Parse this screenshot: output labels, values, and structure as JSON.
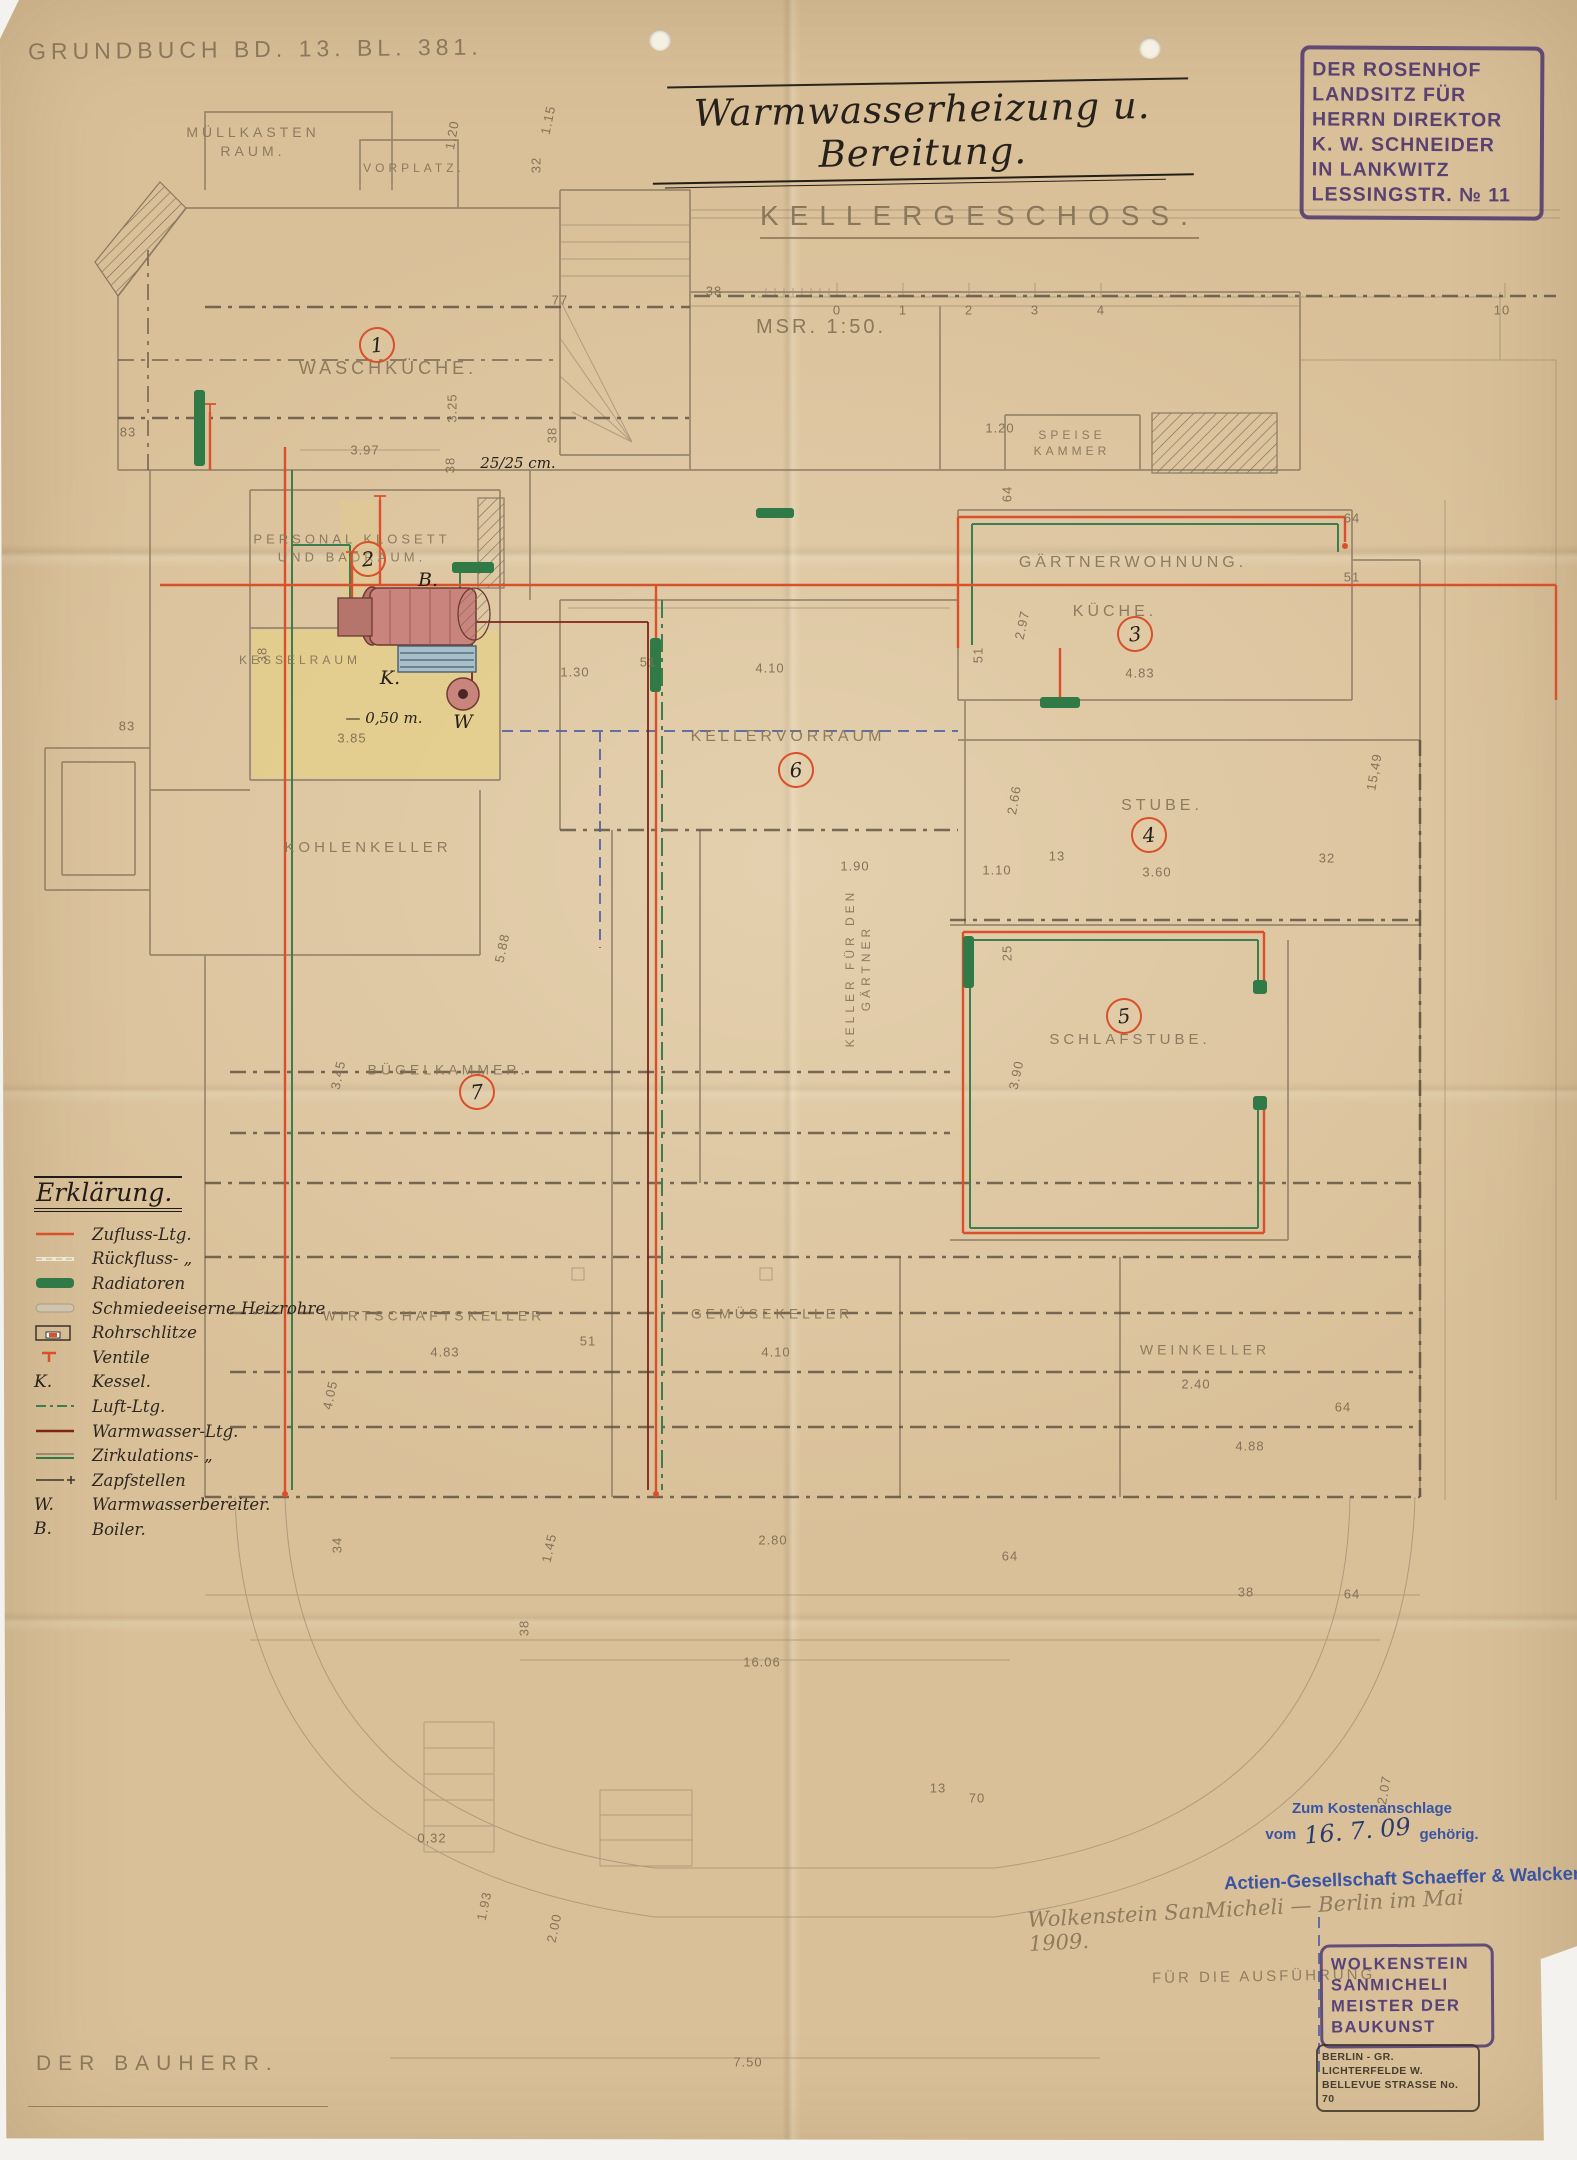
{
  "colors": {
    "paper": "#d9c099",
    "pencil": "#8a7962",
    "ink": "#27211b",
    "supply_red": "#d9502a",
    "warmwasser_dark_red": "#7e2418",
    "radiator_green": "#2f7a46",
    "luft_green": "#3e7d4e",
    "blue_line": "#4e5fa3",
    "stamp_purple": "#533a70",
    "stamp_blue": "#3a54a4",
    "highlight_yellow": "#e8d47b"
  },
  "header": {
    "grundbuch": "Grundbuch Bd. 13. Bl. 381.",
    "title": "Warmwasserheizung u. Bereitung.",
    "floor": "Kellergeschoss.",
    "scale": "Msr. 1:50."
  },
  "owner_stamp": {
    "lines": [
      "DER ROSENHOF",
      "LANDSITZ FÜR",
      "HERRN DIREKTOR",
      "K. W. SCHNEIDER",
      "IN LANKWITZ",
      "LESSINGSTR. № 11"
    ]
  },
  "legend": {
    "title": "Erklärung.",
    "items": [
      {
        "symbol": "supply-line",
        "label": "Zufluss-Ltg."
      },
      {
        "symbol": "return-line",
        "label": "Rückfluss- „"
      },
      {
        "symbol": "radiator",
        "label": "Radiatoren"
      },
      {
        "symbol": "wrought-iron-pipe",
        "label": "Schmiedeeiserne Heizrohre"
      },
      {
        "symbol": "pipe-slot",
        "label": "Rohrschlitze"
      },
      {
        "symbol": "valve",
        "label": "Ventile"
      },
      {
        "symbol": "K.",
        "label": "Kessel."
      },
      {
        "symbol": "air-line",
        "label": "Luft-Ltg."
      },
      {
        "symbol": "hot-water-line",
        "label": "Warmwasser-Ltg."
      },
      {
        "symbol": "circulation-line",
        "label": "Zirkulations- „"
      },
      {
        "symbol": "tap-points",
        "label": "Zapfstellen"
      },
      {
        "symbol": "W.",
        "label": "Warmwasserbereiter."
      },
      {
        "symbol": "B.",
        "label": "Boiler."
      }
    ]
  },
  "plan": {
    "rooms": [
      {
        "label": "MÜLLKASTEN\nRAUM.",
        "x": 253,
        "y": 142,
        "s": 14
      },
      {
        "label": "VORPLATZ.",
        "x": 414,
        "y": 168,
        "s": 12
      },
      {
        "label": "WASCHKÜCHE.",
        "x": 388,
        "y": 368,
        "s": 18
      },
      {
        "label": "PERSONAL KLOSETT\nUND BADRAUM.",
        "x": 352,
        "y": 548,
        "s": 13
      },
      {
        "label": "KESSELRAUM",
        "x": 300,
        "y": 660,
        "s": 12
      },
      {
        "label": "SPEISE\nKAMMER",
        "x": 1072,
        "y": 443,
        "s": 12
      },
      {
        "label": "GÄRTNERWOHNUNG.",
        "x": 1133,
        "y": 563,
        "s": 16
      },
      {
        "label": "KÜCHE.",
        "x": 1115,
        "y": 612,
        "s": 16
      },
      {
        "label": "STUBE.",
        "x": 1162,
        "y": 806,
        "s": 16
      },
      {
        "label": "KELLERVORRAUM",
        "x": 788,
        "y": 737,
        "s": 16
      },
      {
        "label": "KOHLENKELLER",
        "x": 368,
        "y": 848,
        "s": 15
      },
      {
        "label": "SCHLAFSTUBE.",
        "x": 1130,
        "y": 1040,
        "s": 15
      },
      {
        "label": "BÜGELKAMMER.",
        "x": 448,
        "y": 1070,
        "s": 14
      },
      {
        "label": "WIRTSCHAFTSKELLER",
        "x": 434,
        "y": 1316,
        "s": 14
      },
      {
        "label": "GEMÜSEKELLER",
        "x": 772,
        "y": 1314,
        "s": 14
      },
      {
        "label": "WEINKELLER",
        "x": 1205,
        "y": 1350,
        "s": 14
      },
      {
        "label": "KELLER FÜR DEN\nGÄRTNER",
        "x": 858,
        "y": 968,
        "s": 12,
        "rot": -90
      }
    ],
    "numbers": [
      {
        "n": "1",
        "x": 377,
        "y": 345
      },
      {
        "n": "2",
        "x": 368,
        "y": 559
      },
      {
        "n": "3",
        "x": 1135,
        "y": 634
      },
      {
        "n": "4",
        "x": 1149,
        "y": 835
      },
      {
        "n": "5",
        "x": 1124,
        "y": 1016
      },
      {
        "n": "6",
        "x": 796,
        "y": 770
      },
      {
        "n": "7",
        "x": 477,
        "y": 1092
      }
    ],
    "dimensions": [
      {
        "t": "3.97",
        "x": 365,
        "y": 450
      },
      {
        "t": "3.85",
        "x": 352,
        "y": 738
      },
      {
        "t": "1.30",
        "x": 575,
        "y": 672
      },
      {
        "t": "51",
        "x": 648,
        "y": 662
      },
      {
        "t": "4.10",
        "x": 770,
        "y": 668
      },
      {
        "t": "4.83",
        "x": 1140,
        "y": 673
      },
      {
        "t": "2.97",
        "x": 1022,
        "y": 625,
        "r": -78
      },
      {
        "t": "2.66",
        "x": 1014,
        "y": 800,
        "r": -80
      },
      {
        "t": "1.10",
        "x": 997,
        "y": 870
      },
      {
        "t": "13",
        "x": 1057,
        "y": 856
      },
      {
        "t": "3.60",
        "x": 1157,
        "y": 872
      },
      {
        "t": "32",
        "x": 1327,
        "y": 858
      },
      {
        "t": "1.90",
        "x": 855,
        "y": 866
      },
      {
        "t": "25",
        "x": 1007,
        "y": 953,
        "r": -90
      },
      {
        "t": "3.90",
        "x": 1016,
        "y": 1075,
        "r": -78
      },
      {
        "t": "3.45",
        "x": 338,
        "y": 1075,
        "r": -78
      },
      {
        "t": "4.83",
        "x": 445,
        "y": 1352
      },
      {
        "t": "51",
        "x": 588,
        "y": 1341
      },
      {
        "t": "4.10",
        "x": 776,
        "y": 1352
      },
      {
        "t": "4.05",
        "x": 330,
        "y": 1395,
        "r": -78
      },
      {
        "t": "5.88",
        "x": 502,
        "y": 948,
        "r": -78
      },
      {
        "t": "2.40",
        "x": 1196,
        "y": 1384
      },
      {
        "t": "64",
        "x": 1343,
        "y": 1407
      },
      {
        "t": "4.88",
        "x": 1250,
        "y": 1446
      },
      {
        "t": "64",
        "x": 1352,
        "y": 1594
      },
      {
        "t": "15,49",
        "x": 1374,
        "y": 772,
        "r": -80
      },
      {
        "t": "2.07",
        "x": 1384,
        "y": 1790,
        "r": -80
      },
      {
        "t": "83",
        "x": 128,
        "y": 432
      },
      {
        "t": "83",
        "x": 127,
        "y": 726
      },
      {
        "t": "38",
        "x": 262,
        "y": 655,
        "r": -90
      },
      {
        "t": "3.25",
        "x": 452,
        "y": 408,
        "r": -90
      },
      {
        "t": "38",
        "x": 450,
        "y": 465,
        "r": -90
      },
      {
        "t": "77",
        "x": 560,
        "y": 300
      },
      {
        "t": "38",
        "x": 552,
        "y": 435,
        "r": -90
      },
      {
        "t": "38",
        "x": 714,
        "y": 291
      },
      {
        "t": "1.15",
        "x": 548,
        "y": 120,
        "r": -78
      },
      {
        "t": "32",
        "x": 536,
        "y": 165,
        "r": -90
      },
      {
        "t": "1.20",
        "x": 452,
        "y": 135,
        "r": -80
      },
      {
        "t": "1.20",
        "x": 1000,
        "y": 428
      },
      {
        "t": "64",
        "x": 1007,
        "y": 494,
        "r": -90
      },
      {
        "t": "64",
        "x": 1352,
        "y": 518
      },
      {
        "t": "51",
        "x": 1352,
        "y": 577
      },
      {
        "t": "51",
        "x": 978,
        "y": 655,
        "r": -90
      },
      {
        "t": "2.80",
        "x": 773,
        "y": 1540
      },
      {
        "t": "1.45",
        "x": 549,
        "y": 1548,
        "r": -78
      },
      {
        "t": "16.06",
        "x": 762,
        "y": 1662
      },
      {
        "t": "38",
        "x": 524,
        "y": 1628,
        "r": -90
      },
      {
        "t": "7.50",
        "x": 748,
        "y": 2062
      },
      {
        "t": "0,32",
        "x": 432,
        "y": 1838
      },
      {
        "t": "1.93",
        "x": 484,
        "y": 1906,
        "r": -78
      },
      {
        "t": "2.00",
        "x": 554,
        "y": 1928,
        "r": -78
      },
      {
        "t": "13",
        "x": 938,
        "y": 1788
      },
      {
        "t": "70",
        "x": 977,
        "y": 1798
      },
      {
        "t": "38",
        "x": 1246,
        "y": 1592
      },
      {
        "t": "64",
        "x": 1010,
        "y": 1556
      },
      {
        "t": "34",
        "x": 337,
        "y": 1545,
        "r": -90
      },
      {
        "t": "0",
        "x": 837,
        "y": 310
      },
      {
        "t": "1",
        "x": 903,
        "y": 310
      },
      {
        "t": "2",
        "x": 969,
        "y": 310
      },
      {
        "t": "3",
        "x": 1035,
        "y": 310
      },
      {
        "t": "4",
        "x": 1101,
        "y": 310
      },
      {
        "t": "10",
        "x": 1502,
        "y": 310
      }
    ],
    "notes": [
      {
        "t": "25/25 cm.",
        "x": 518,
        "y": 463
      },
      {
        "t": "— 0,50 m.",
        "x": 384,
        "y": 718
      }
    ],
    "equipment": {
      "boiler": "B.",
      "kessel": "K.",
      "heater": "W"
    }
  },
  "footer": {
    "kostenanschlag": {
      "line1": "Zum Kostenanschlage",
      "vom": "vom",
      "date": "16. 7. 09",
      "post": "gehörig."
    },
    "company": "Actien-Gesellschaft Schaeffer & Walcker",
    "pencil_signature": "Wolkenstein SanMicheli — Berlin im Mai 1909.",
    "pencil_execution": "Für die Ausführung",
    "builder_stamp": [
      "WOLKENSTEIN",
      "SANMICHELI",
      "MEISTER DER",
      "BAUKUNST"
    ],
    "address_stamp": [
      "BERLIN - GR. LICHTERFELDE W.",
      "BELLEVUE STRASSE No. 70"
    ],
    "bauherr": "Der Bauherr."
  }
}
